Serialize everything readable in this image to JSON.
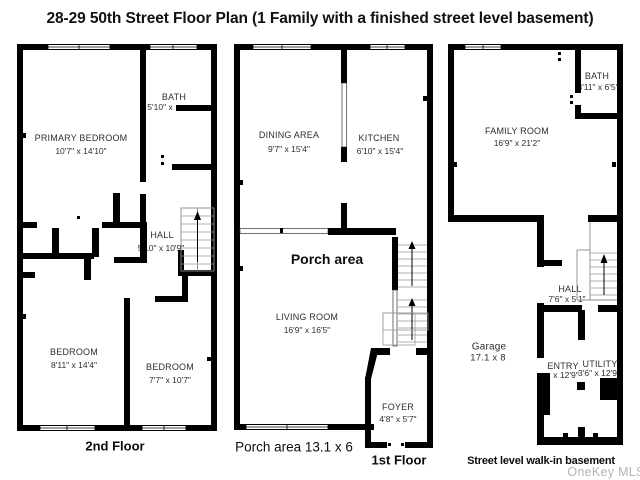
{
  "title": "28-29 50th Street Floor Plan (1 Family with a finished street level basement)",
  "watermark": "OneKey MLS",
  "floors": {
    "second": {
      "label": "2nd Floor",
      "rooms": {
        "primary_bedroom": {
          "name": "PRIMARY BEDROOM",
          "dims": "10'7\" x 14'10\""
        },
        "bath": {
          "name": "BATH",
          "dims": "5'10\" x"
        },
        "hall": {
          "name": "HALL",
          "dims": "5'10\" x 10'9\""
        },
        "bedroom_left": {
          "name": "BEDROOM",
          "dims": "8'11\" x 14'4\""
        },
        "bedroom_right": {
          "name": "BEDROOM",
          "dims": "7'7\" x 10'7\""
        }
      }
    },
    "first": {
      "label": "1st Floor",
      "porch_note": "Porch area 13.1 x 6",
      "rooms": {
        "dining": {
          "name": "DINING AREA",
          "dims": "9'7\" x 15'4\""
        },
        "kitchen": {
          "name": "KITCHEN",
          "dims": "6'10\" x 15'4\""
        },
        "porch": {
          "name": "Porch area"
        },
        "living": {
          "name": "LIVING ROOM",
          "dims": "16'9\" x 16'5\""
        },
        "foyer": {
          "name": "FOYER",
          "dims": "4'8\" x 5'7\""
        }
      }
    },
    "basement": {
      "label": "Street level walk-in basement",
      "rooms": {
        "bath": {
          "name": "BATH",
          "dims": "3'11\" x 6'5\""
        },
        "family_room": {
          "name": "FAMILY ROOM",
          "dims": "16'9\" x 21'2\""
        },
        "hall": {
          "name": "HALL",
          "dims": "7'6\" x 5'1\""
        },
        "garage": {
          "name": "Garage",
          "dims": "17.1 x 8"
        },
        "entry": {
          "name": "ENTRY",
          "dims": "x 12'9\""
        },
        "utility": {
          "name": "UTILITY",
          "dims": "3'6\" x 12'9\""
        }
      }
    }
  }
}
